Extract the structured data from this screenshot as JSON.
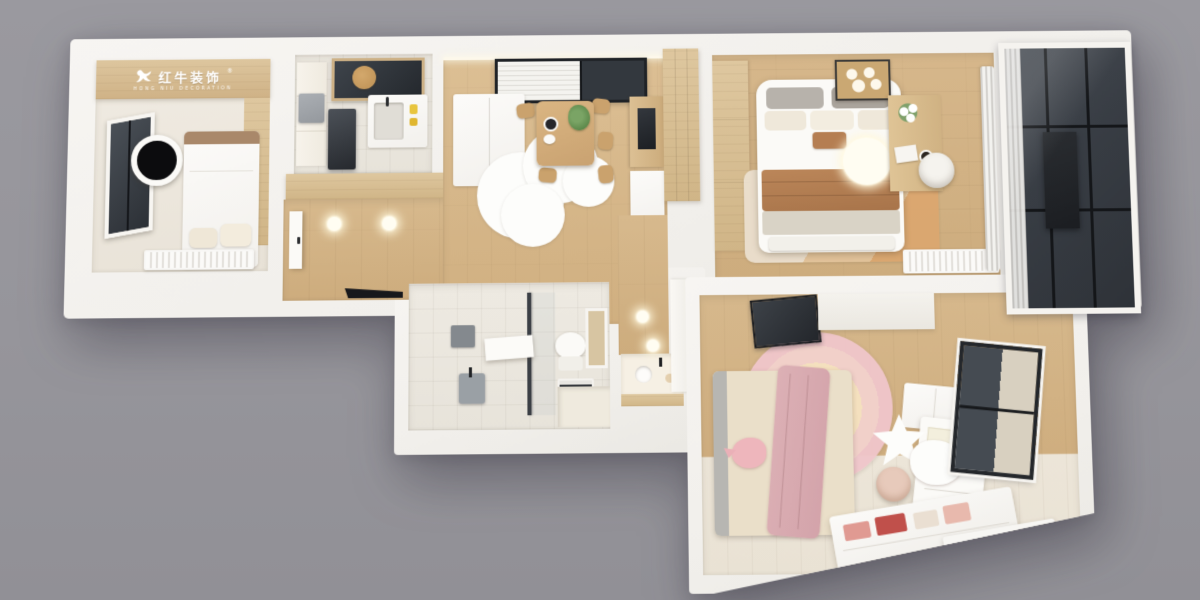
{
  "canvas": {
    "width": 1200,
    "height": 600,
    "background_color": "#97969c"
  },
  "scene": {
    "type": "3d-floorplan-render",
    "description": "top-down 3D rendered apartment floor plan with white walls"
  },
  "logo": {
    "brand_cn": "红牛装饰",
    "brand_en": "HONG NIU DECORATION",
    "registered_mark": "®",
    "text_color": "#ffffff",
    "band_color": "#d5bb92",
    "icon": "hongniu-bull-icon"
  },
  "palette": {
    "background": "#97969c",
    "wall": "#f3f1ed",
    "wood_floor": "#d2b084",
    "wood_panel": "#dcc49c",
    "tile": "#ece8e0",
    "dark_glass": "#3d4147",
    "accent_brown": "#b27e55",
    "accent_pink": "#e9bcc1",
    "light_glow": "#fff8e6"
  },
  "rooms": [
    {
      "id": "secondary-bedroom",
      "position": "top-left",
      "features": [
        "window",
        "round-wall-lamp",
        "single-bed",
        "pillows",
        "wood-headboard-wall",
        "radiator",
        "brand-logo-band"
      ]
    },
    {
      "id": "kitchen",
      "position": "top-left-center",
      "features": [
        "window",
        "tall-cabinet",
        "gray-wall-box",
        "dark-refrigerator",
        "sink-counter",
        "faucet",
        "cutting-board"
      ]
    },
    {
      "id": "entry-hall",
      "position": "left-center",
      "features": [
        "entry-door",
        "two-ceiling-lights",
        "wood-floor",
        "storage-band",
        "dark-door-gap"
      ]
    },
    {
      "id": "dining-living-room",
      "position": "center",
      "features": [
        "glazed-window-with-blinds",
        "white-refrigerator",
        "wood-dining-table",
        "plates",
        "plant",
        "five-chairs",
        "cloud-shaped-rug",
        "tv-sideboard",
        "lower-cabinet",
        "led-cove-light"
      ]
    },
    {
      "id": "bathroom",
      "position": "bottom-center",
      "features": [
        "shower-glass-partition",
        "mirror",
        "washbasin",
        "toilet",
        "towel-radiator",
        "shaded-window",
        "step-platform"
      ]
    },
    {
      "id": "corridor-vanity",
      "position": "center-south",
      "features": [
        "wood-floor",
        "ceiling-light",
        "vanity-counter",
        "round-sink",
        "black-faucet",
        "wood-apron",
        "tall-white-cabinet"
      ]
    },
    {
      "id": "master-bedroom",
      "position": "top-right",
      "features": [
        "wood-wardrobe",
        "double-bed",
        "gray-pillows",
        "cream-pillows",
        "brown-accent-pillow",
        "brown-throw",
        "foot-bench",
        "square-ceiling-lamp",
        "round-pendant-lamp",
        "area-rug",
        "desk",
        "flowers",
        "coffee-cup",
        "round-chair",
        "radiator",
        "sheer-curtains",
        "wood-sliding-door"
      ]
    },
    {
      "id": "balcony",
      "position": "far-right",
      "features": [
        "floor-to-ceiling-glazing",
        "black-mullions",
        "gathered-curtain",
        "dark-wall-panel"
      ]
    },
    {
      "id": "kids-bedroom",
      "position": "bottom-right",
      "features": [
        "dark-glass-panel",
        "shelf-band",
        "bed",
        "pink-blanket",
        "pink-whale-plush",
        "rainbow-round-rug",
        "star-mirror",
        "cloud-mirror",
        "white-desk",
        "pegboard",
        "chair",
        "wardrobe-boxes",
        "window-with-roller-shade",
        "toy-storage-bench",
        "radiator"
      ]
    }
  ]
}
